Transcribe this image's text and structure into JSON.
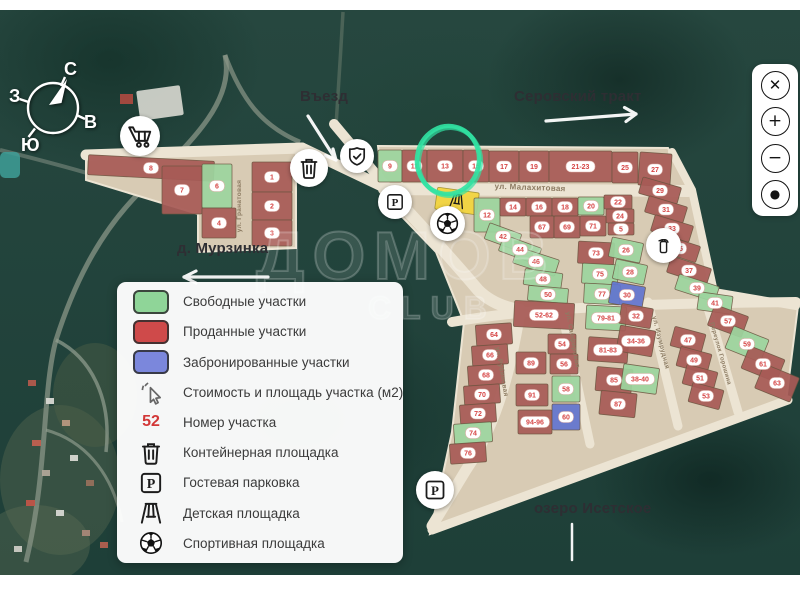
{
  "compass": {
    "north": "С",
    "east": "В",
    "south": "Ю",
    "west": "З"
  },
  "labels": {
    "entrance": "Въезд",
    "highway": "Серовский тракт",
    "village": "д. Мурзинка",
    "lake": "озеро Исетское"
  },
  "watermark": {
    "line1": "ДОМОВ",
    "line2": "CLUB"
  },
  "colors": {
    "free": "#9cd49e",
    "sold": "#a75a56",
    "reserved": "#6274cf",
    "playground": "#f2d43c",
    "badge_text": "#d64545",
    "land": "#d8cbb4",
    "road": "#ece4d3",
    "highlight": "#31e3a3"
  },
  "legend_colors": {
    "free": "#8fd598",
    "sold": "#cf4a4a",
    "reserved": "#7b87dc"
  },
  "legend": {
    "items": [
      {
        "type": "swatch",
        "key": "free",
        "label": "Свободные участки"
      },
      {
        "type": "swatch",
        "key": "sold",
        "label": "Проданные участки"
      },
      {
        "type": "swatch",
        "key": "reserved",
        "label": "Забронированные участки"
      },
      {
        "type": "icon",
        "glyph": "cursor-click",
        "name": "cursor-click-icon",
        "label": "Стоимость и площадь участка (м2)"
      },
      {
        "type": "number",
        "value": "52",
        "label": "Номер участка"
      },
      {
        "type": "icon",
        "glyph": "trash",
        "name": "trash-icon",
        "label": "Контейнерная площадка"
      },
      {
        "type": "icon",
        "glyph": "parking",
        "name": "parking-icon",
        "label": "Гостевая парковка"
      },
      {
        "type": "icon",
        "glyph": "swing",
        "name": "swing-icon",
        "label": "Детская площадка"
      },
      {
        "type": "icon",
        "glyph": "soccer",
        "name": "soccer-icon",
        "label": "Спортивная площадка"
      }
    ]
  },
  "controls": {
    "buttons": [
      {
        "name": "close-button",
        "glyph": "✕"
      },
      {
        "name": "zoom-in-button",
        "glyph": "+"
      },
      {
        "name": "zoom-out-button",
        "glyph": "−"
      },
      {
        "name": "locate-button",
        "glyph": "●"
      }
    ]
  },
  "markers": [
    {
      "name": "shop-cart-icon",
      "glyph": "cart",
      "x": 140,
      "y": 136,
      "d": 40
    },
    {
      "name": "trash-icon",
      "glyph": "trash",
      "x": 309,
      "y": 168,
      "d": 38
    },
    {
      "name": "shield-check-icon",
      "glyph": "shield-check",
      "x": 357,
      "y": 156,
      "d": 34
    },
    {
      "name": "guest-parking-north-icon",
      "glyph": "parking",
      "x": 395,
      "y": 202,
      "d": 34
    },
    {
      "name": "sports-ground-icon",
      "glyph": "soccer",
      "x": 447,
      "y": 223,
      "d": 35
    },
    {
      "name": "hydrant-icon",
      "glyph": "hydrant",
      "x": 663,
      "y": 245,
      "d": 35
    },
    {
      "name": "guest-parking-south-icon",
      "glyph": "parking",
      "x": 435,
      "y": 490,
      "d": 38
    }
  ],
  "streets": [
    {
      "name": "ул. Гранатовая",
      "x": 241,
      "y": 206,
      "rot": -90,
      "size": 6.5
    },
    {
      "name": "ул. Малахитовая",
      "x": 530,
      "y": 190,
      "rot": 2,
      "size": 8
    },
    {
      "name": "ул. Рубиновая",
      "x": 500,
      "y": 372,
      "rot": 80,
      "size": 6.5
    },
    {
      "name": "ул. Сапфировая",
      "x": 571,
      "y": 340,
      "rot": 80,
      "size": 6.5
    },
    {
      "name": "ул. Изумрудная",
      "x": 659,
      "y": 343,
      "rot": 76,
      "size": 6.5
    },
    {
      "name": "Переулок Горошина",
      "x": 719,
      "y": 354,
      "rot": 74,
      "size": 6
    }
  ],
  "highlight": {
    "x": 448,
    "y": 160,
    "rx": 31,
    "ry": 34,
    "rot": 8
  },
  "plots": [
    {
      "n": "8",
      "x": 88,
      "y": 158,
      "w": 126,
      "h": 20,
      "r": 3,
      "s": "sold"
    },
    {
      "n": "7",
      "x": 162,
      "y": 166,
      "w": 40,
      "h": 48,
      "r": 0,
      "s": "sold"
    },
    {
      "n": "6",
      "x": 202,
      "y": 164,
      "w": 30,
      "h": 44,
      "r": 0,
      "s": "free"
    },
    {
      "n": "4",
      "x": 202,
      "y": 208,
      "w": 34,
      "h": 30,
      "r": 0,
      "s": "sold"
    },
    {
      "n": "1",
      "x": 252,
      "y": 162,
      "w": 40,
      "h": 30,
      "r": 0,
      "s": "sold"
    },
    {
      "n": "2",
      "x": 252,
      "y": 192,
      "w": 40,
      "h": 28,
      "r": 0,
      "s": "sold"
    },
    {
      "n": "3",
      "x": 252,
      "y": 220,
      "w": 40,
      "h": 26,
      "r": 0,
      "s": "sold"
    },
    {
      "n": "9",
      "x": 378,
      "y": 150,
      "w": 24,
      "h": 32,
      "r": 0,
      "s": "free"
    },
    {
      "n": "11",
      "x": 402,
      "y": 150,
      "w": 25,
      "h": 32,
      "r": 0,
      "s": "sold"
    },
    {
      "n": "13",
      "x": 427,
      "y": 150,
      "w": 36,
      "h": 32,
      "r": 0,
      "s": "sold"
    },
    {
      "n": "15",
      "x": 463,
      "y": 150,
      "w": 26,
      "h": 32,
      "r": 0,
      "s": "sold"
    },
    {
      "n": "17",
      "x": 489,
      "y": 151,
      "w": 30,
      "h": 31,
      "r": 0,
      "s": "sold"
    },
    {
      "n": "19",
      "x": 519,
      "y": 151,
      "w": 30,
      "h": 31,
      "r": 0,
      "s": "sold"
    },
    {
      "n": "21-23",
      "x": 549,
      "y": 151,
      "w": 63,
      "h": 31,
      "r": 0,
      "s": "sold"
    },
    {
      "n": "25",
      "x": 612,
      "y": 152,
      "w": 26,
      "h": 31,
      "r": 0,
      "s": "sold"
    },
    {
      "n": "27",
      "x": 639,
      "y": 153,
      "w": 32,
      "h": 33,
      "r": 4,
      "s": "sold"
    },
    {
      "n": "",
      "x": 436,
      "y": 190,
      "w": 42,
      "h": 22,
      "r": 8,
      "s": "playground"
    },
    {
      "n": "12",
      "x": 474,
      "y": 198,
      "w": 26,
      "h": 34,
      "r": 0,
      "s": "free"
    },
    {
      "n": "14",
      "x": 500,
      "y": 198,
      "w": 26,
      "h": 18,
      "r": 0,
      "s": "sold"
    },
    {
      "n": "16",
      "x": 526,
      "y": 198,
      "w": 26,
      "h": 18,
      "r": 0,
      "s": "sold"
    },
    {
      "n": "18",
      "x": 552,
      "y": 198,
      "w": 26,
      "h": 18,
      "r": 0,
      "s": "sold"
    },
    {
      "n": "20",
      "x": 578,
      "y": 197,
      "w": 26,
      "h": 18,
      "r": 0,
      "s": "free"
    },
    {
      "n": "22",
      "x": 604,
      "y": 195,
      "w": 28,
      "h": 14,
      "r": 0,
      "s": "sold"
    },
    {
      "n": "24",
      "x": 606,
      "y": 209,
      "w": 28,
      "h": 14,
      "r": 0,
      "s": "sold"
    },
    {
      "n": "5",
      "x": 608,
      "y": 223,
      "w": 26,
      "h": 12,
      "r": 0,
      "s": "sold"
    },
    {
      "n": "67",
      "x": 530,
      "y": 216,
      "w": 24,
      "h": 22,
      "r": 0,
      "s": "sold"
    },
    {
      "n": "69",
      "x": 554,
      "y": 216,
      "w": 26,
      "h": 22,
      "r": 0,
      "s": "sold"
    },
    {
      "n": "71",
      "x": 580,
      "y": 216,
      "w": 26,
      "h": 20,
      "r": 0,
      "s": "sold"
    },
    {
      "n": "29",
      "x": 640,
      "y": 182,
      "w": 40,
      "h": 17,
      "r": 16,
      "s": "sold"
    },
    {
      "n": "31",
      "x": 646,
      "y": 201,
      "w": 40,
      "h": 17,
      "r": 17,
      "s": "sold"
    },
    {
      "n": "33",
      "x": 652,
      "y": 220,
      "w": 40,
      "h": 17,
      "r": 17,
      "s": "sold"
    },
    {
      "n": "35",
      "x": 659,
      "y": 240,
      "w": 40,
      "h": 17,
      "r": 18,
      "s": "sold"
    },
    {
      "n": "37",
      "x": 668,
      "y": 262,
      "w": 42,
      "h": 17,
      "r": 18,
      "s": "sold"
    },
    {
      "n": "39",
      "x": 676,
      "y": 280,
      "w": 42,
      "h": 16,
      "r": 18,
      "s": "free"
    },
    {
      "n": "42",
      "x": 486,
      "y": 228,
      "w": 34,
      "h": 17,
      "r": 20,
      "s": "free"
    },
    {
      "n": "44",
      "x": 500,
      "y": 241,
      "w": 40,
      "h": 17,
      "r": 20,
      "s": "free"
    },
    {
      "n": "46",
      "x": 514,
      "y": 253,
      "w": 44,
      "h": 17,
      "r": 18,
      "s": "free"
    },
    {
      "n": "48",
      "x": 524,
      "y": 271,
      "w": 38,
      "h": 16,
      "r": 8,
      "s": "free"
    },
    {
      "n": "50",
      "x": 528,
      "y": 287,
      "w": 40,
      "h": 15,
      "r": 5,
      "s": "free"
    },
    {
      "n": "52-62",
      "x": 514,
      "y": 302,
      "w": 60,
      "h": 26,
      "r": 3,
      "s": "sold"
    },
    {
      "n": "89",
      "x": 516,
      "y": 352,
      "w": 30,
      "h": 22,
      "r": 0,
      "s": "sold"
    },
    {
      "n": "91",
      "x": 516,
      "y": 384,
      "w": 32,
      "h": 22,
      "r": 0,
      "s": "sold"
    },
    {
      "n": "94-96",
      "x": 518,
      "y": 410,
      "w": 34,
      "h": 24,
      "r": 0,
      "s": "sold"
    },
    {
      "n": "54",
      "x": 548,
      "y": 334,
      "w": 28,
      "h": 20,
      "r": 0,
      "s": "sold"
    },
    {
      "n": "56",
      "x": 550,
      "y": 354,
      "w": 28,
      "h": 20,
      "r": 0,
      "s": "sold"
    },
    {
      "n": "58",
      "x": 552,
      "y": 376,
      "w": 28,
      "h": 26,
      "r": 0,
      "s": "free"
    },
    {
      "n": "60",
      "x": 552,
      "y": 404,
      "w": 28,
      "h": 26,
      "r": 0,
      "s": "reserved"
    },
    {
      "n": "64",
      "x": 476,
      "y": 324,
      "w": 36,
      "h": 21,
      "r": -4,
      "s": "sold"
    },
    {
      "n": "66",
      "x": 472,
      "y": 345,
      "w": 36,
      "h": 20,
      "r": -4,
      "s": "sold"
    },
    {
      "n": "68",
      "x": 468,
      "y": 365,
      "w": 36,
      "h": 20,
      "r": -4,
      "s": "sold"
    },
    {
      "n": "70",
      "x": 464,
      "y": 385,
      "w": 36,
      "h": 19,
      "r": -4,
      "s": "sold"
    },
    {
      "n": "72",
      "x": 460,
      "y": 404,
      "w": 36,
      "h": 19,
      "r": -4,
      "s": "sold"
    },
    {
      "n": "74",
      "x": 454,
      "y": 423,
      "w": 38,
      "h": 20,
      "r": -4,
      "s": "free"
    },
    {
      "n": "76",
      "x": 450,
      "y": 443,
      "w": 36,
      "h": 20,
      "r": -4,
      "s": "sold"
    },
    {
      "n": "73",
      "x": 578,
      "y": 242,
      "w": 36,
      "h": 22,
      "r": 3,
      "s": "sold"
    },
    {
      "n": "75",
      "x": 582,
      "y": 264,
      "w": 36,
      "h": 20,
      "r": 3,
      "s": "free"
    },
    {
      "n": "77",
      "x": 584,
      "y": 284,
      "w": 36,
      "h": 20,
      "r": 3,
      "s": "free"
    },
    {
      "n": "79-81",
      "x": 586,
      "y": 306,
      "w": 40,
      "h": 24,
      "r": 3,
      "s": "free"
    },
    {
      "n": "81-83",
      "x": 588,
      "y": 338,
      "w": 40,
      "h": 24,
      "r": 4,
      "s": "sold"
    },
    {
      "n": "85",
      "x": 596,
      "y": 368,
      "w": 36,
      "h": 24,
      "r": 5,
      "s": "sold"
    },
    {
      "n": "87",
      "x": 600,
      "y": 392,
      "w": 36,
      "h": 24,
      "r": 6,
      "s": "sold"
    },
    {
      "n": "26",
      "x": 610,
      "y": 240,
      "w": 32,
      "h": 20,
      "r": 12,
      "s": "free"
    },
    {
      "n": "28",
      "x": 614,
      "y": 262,
      "w": 32,
      "h": 20,
      "r": 12,
      "s": "free"
    },
    {
      "n": "30",
      "x": 610,
      "y": 284,
      "w": 34,
      "h": 22,
      "r": 10,
      "s": "reserved"
    },
    {
      "n": "32",
      "x": 620,
      "y": 306,
      "w": 32,
      "h": 20,
      "r": 10,
      "s": "sold"
    },
    {
      "n": "34-36",
      "x": 618,
      "y": 328,
      "w": 36,
      "h": 26,
      "r": 10,
      "s": "sold"
    },
    {
      "n": "38-40",
      "x": 622,
      "y": 366,
      "w": 36,
      "h": 26,
      "r": 8,
      "s": "free"
    },
    {
      "n": "47",
      "x": 672,
      "y": 330,
      "w": 32,
      "h": 20,
      "r": 15,
      "s": "sold"
    },
    {
      "n": "49",
      "x": 678,
      "y": 350,
      "w": 32,
      "h": 20,
      "r": 15,
      "s": "sold"
    },
    {
      "n": "51",
      "x": 684,
      "y": 368,
      "w": 32,
      "h": 20,
      "r": 15,
      "s": "sold"
    },
    {
      "n": "53",
      "x": 690,
      "y": 386,
      "w": 32,
      "h": 20,
      "r": 15,
      "s": "sold"
    },
    {
      "n": "41",
      "x": 698,
      "y": 294,
      "w": 34,
      "h": 18,
      "r": 8,
      "s": "free"
    },
    {
      "n": "57",
      "x": 710,
      "y": 310,
      "w": 36,
      "h": 22,
      "r": 20,
      "s": "sold"
    },
    {
      "n": "59",
      "x": 728,
      "y": 332,
      "w": 38,
      "h": 24,
      "r": 22,
      "s": "free"
    },
    {
      "n": "61",
      "x": 744,
      "y": 352,
      "w": 38,
      "h": 24,
      "r": 22,
      "s": "sold"
    },
    {
      "n": "63",
      "x": 758,
      "y": 370,
      "w": 38,
      "h": 26,
      "r": 22,
      "s": "sold"
    }
  ]
}
